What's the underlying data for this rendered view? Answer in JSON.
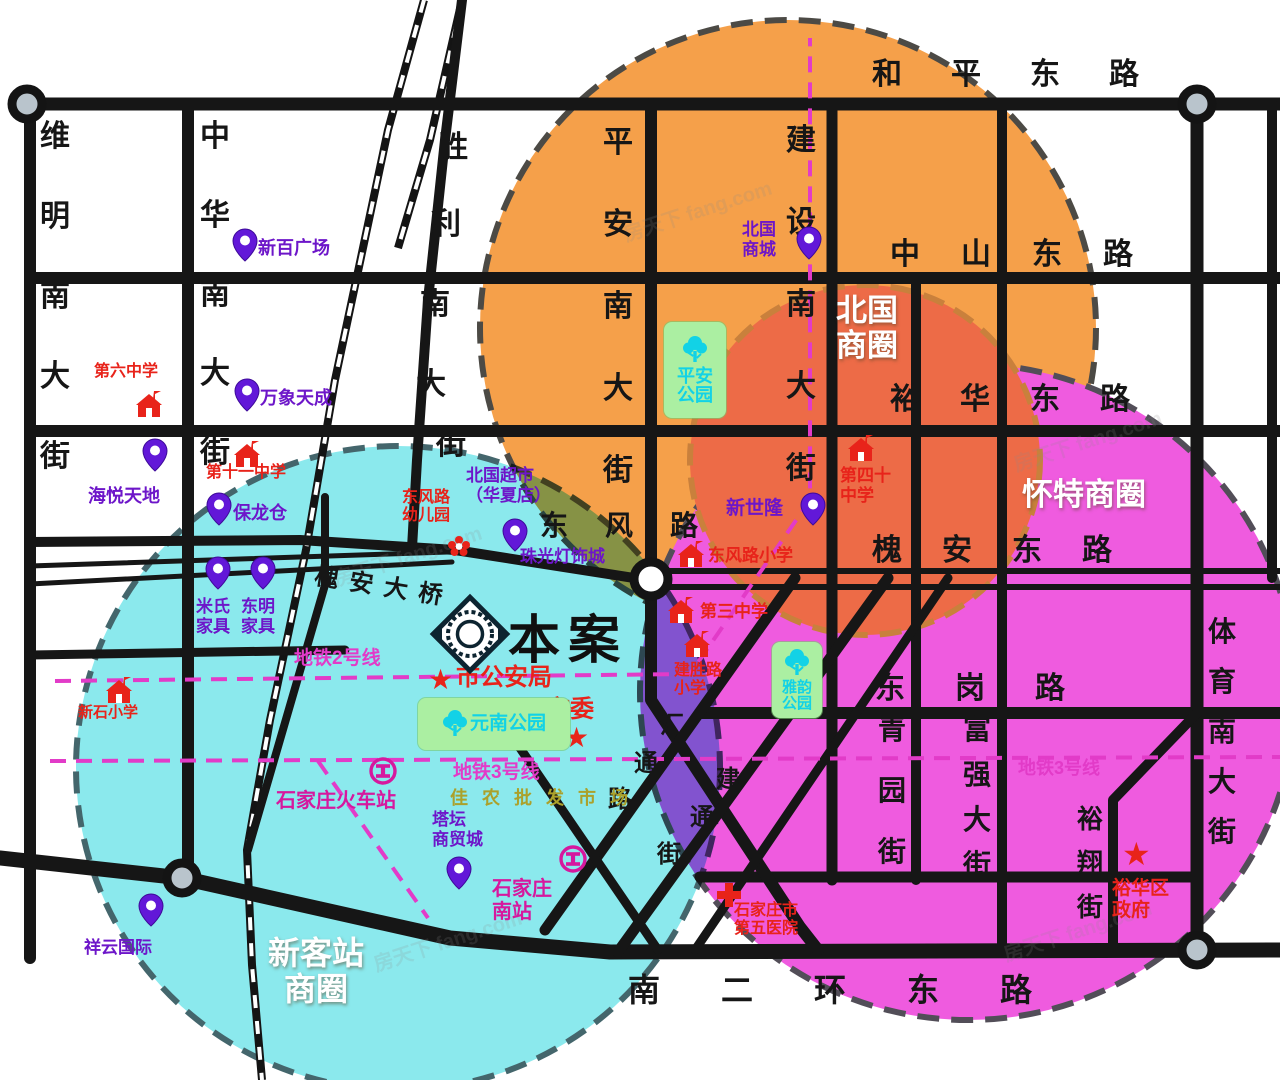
{
  "map": {
    "project_marker": {
      "label": "本案",
      "x": 424,
      "y": 588,
      "text_x": 508,
      "text_y": 598,
      "text_size": 52
    },
    "business_circles": [
      {
        "name": "北国商圈",
        "cx": 788,
        "cy": 328,
        "r": 308,
        "fill": "#F5A04A",
        "dash": "#4C4A45",
        "label_lines": [
          "北国",
          "商圈"
        ],
        "label_x": 836,
        "label_y": 294,
        "label_size": 31,
        "label_layout": "lines"
      },
      {
        "name": "怀特商圈",
        "cx": 968,
        "cy": 692,
        "r": 328,
        "fill": "#EF5BDF",
        "dash": "#524E58",
        "label_lines": [
          "怀特商圈"
        ],
        "label_x": 1022,
        "label_y": 478,
        "label_size": 31,
        "label_layout": "lines"
      },
      {
        "name": "新客站商圈",
        "cx": 398,
        "cy": 768,
        "r": 322,
        "fill": "#8BE9ED",
        "dash": "#44666C",
        "blend": "multiply",
        "label_lines": [
          "新客站",
          "商圈"
        ],
        "label_x": 268,
        "label_y": 936,
        "label_size": 32,
        "label_layout": "center"
      },
      {
        "name": "北国商圈核心",
        "cx": 865,
        "cy": 460,
        "r": 175,
        "fill": "#ED6B47",
        "dash": "#C9803C",
        "label_lines": [],
        "label_x": 0,
        "label_y": 0,
        "label_size": 0,
        "label_layout": "none"
      }
    ],
    "streets": [
      {
        "name": "和平东路",
        "o": "h",
        "x": 872,
        "y": 60,
        "sp": 79,
        "size": 30
      },
      {
        "name": "中山东路",
        "o": "h",
        "x": 890,
        "y": 240,
        "sp": 71,
        "size": 30
      },
      {
        "name": "裕华东路",
        "o": "h",
        "x": 890,
        "y": 385,
        "sp": 70,
        "size": 30
      },
      {
        "name": "槐安东路",
        "o": "h",
        "x": 872,
        "y": 536,
        "sp": 70,
        "size": 30
      },
      {
        "name": "东风路",
        "o": "h",
        "x": 540,
        "y": 512,
        "sp": 65,
        "size": 28
      },
      {
        "name": "东岗路",
        "o": "h",
        "x": 875,
        "y": 674,
        "sp": 80,
        "size": 30
      },
      {
        "name": "南二环东路",
        "o": "h",
        "x": 628,
        "y": 974,
        "sp": 93,
        "size": 32
      },
      {
        "name": "维明南大街",
        "o": "v",
        "x": 40,
        "y": 122,
        "sp": 80,
        "size": 30
      },
      {
        "name": "中华南大街",
        "o": "v",
        "x": 200,
        "y": 122,
        "sp": 79,
        "size": 30
      },
      {
        "name": "胜利南大街",
        "o": "v",
        "size": 30,
        "pos": [
          [
            438,
            133
          ],
          [
            431,
            210
          ],
          [
            420,
            290
          ],
          [
            416,
            370
          ],
          [
            436,
            430
          ]
        ]
      },
      {
        "name": "平安南大街",
        "o": "v",
        "x": 603,
        "y": 128,
        "sp": 82,
        "size": 30
      },
      {
        "name": "建设南大街",
        "o": "v",
        "x": 786,
        "y": 126,
        "sp": 82,
        "size": 30
      },
      {
        "name": "青园街",
        "o": "v",
        "x": 878,
        "y": 716,
        "sp": 61,
        "size": 28
      },
      {
        "name": "富强大街",
        "o": "v",
        "x": 963,
        "y": 716,
        "sp": 45,
        "size": 28
      },
      {
        "name": "裕翔街",
        "o": "v",
        "x": 1077,
        "y": 806,
        "sp": 44,
        "size": 26
      },
      {
        "name": "体育南大街",
        "o": "v",
        "x": 1208,
        "y": 618,
        "sp": 50,
        "size": 28
      },
      {
        "name": "槐安大桥",
        "o": "h",
        "x": 318,
        "y": 556,
        "sp": 35,
        "size": 24,
        "rotate": 9
      },
      {
        "name": "汇通路",
        "o": "v",
        "size": 24,
        "pos": [
          [
            660,
            714
          ],
          [
            634,
            752
          ],
          [
            608,
            788
          ]
        ]
      },
      {
        "name": "建通街",
        "o": "v",
        "size": 24,
        "pos": [
          [
            716,
            768
          ],
          [
            690,
            806
          ],
          [
            657,
            843
          ]
        ]
      }
    ],
    "pois": [
      {
        "type": "pin",
        "x": 232,
        "y": 228,
        "label": "新百广场",
        "lx": 258,
        "ly": 238,
        "lc": "purple",
        "ls": 18
      },
      {
        "type": "pin",
        "x": 234,
        "y": 378,
        "label": "万象天成",
        "lx": 260,
        "ly": 388,
        "lc": "purple",
        "ls": 18
      },
      {
        "type": "school",
        "x": 134,
        "y": 390,
        "label": "第六中学",
        "lx": 94,
        "ly": 363,
        "lc": "red",
        "ls": 16
      },
      {
        "type": "pin",
        "x": 142,
        "y": 438,
        "label": "海悦天地",
        "lx": 88,
        "ly": 486,
        "lc": "purple",
        "ls": 18
      },
      {
        "type": "school",
        "x": 232,
        "y": 440,
        "label": "第十一中学",
        "lx": 206,
        "ly": 464,
        "lc": "red",
        "ls": 16
      },
      {
        "type": "pin",
        "x": 206,
        "y": 492,
        "label": "保龙仓",
        "lx": 233,
        "ly": 503,
        "lc": "purple",
        "ls": 18
      },
      {
        "type": "pin",
        "x": 205,
        "y": 556,
        "label": "米氏\n家具",
        "lx": 196,
        "ly": 597,
        "lc": "purple",
        "ls": 17
      },
      {
        "type": "pin",
        "x": 250,
        "y": 556,
        "label": "东明\n家具",
        "lx": 241,
        "ly": 597,
        "lc": "purple",
        "ls": 17
      },
      {
        "type": "school",
        "x": 104,
        "y": 676,
        "label": "新石小学",
        "lx": 78,
        "ly": 704,
        "lc": "red",
        "ls": 15
      },
      {
        "type": "pin",
        "x": 138,
        "y": 893,
        "label": "祥云国际",
        "lx": 84,
        "ly": 938,
        "lc": "purple",
        "ls": 17
      },
      {
        "type": "flower",
        "x": 446,
        "y": 534,
        "label": "东风路\n幼儿园",
        "lx": 402,
        "ly": 489,
        "lc": "red",
        "ls": 16
      },
      {
        "type": "text",
        "x": 0,
        "y": 0,
        "label": "北国超市\n（华夏店）",
        "lx": 466,
        "ly": 466,
        "lc": "purple",
        "ls": 17
      },
      {
        "type": "pin",
        "x": 502,
        "y": 518,
        "label": "珠光灯饰城",
        "lx": 520,
        "ly": 547,
        "lc": "purple",
        "ls": 17
      },
      {
        "type": "school",
        "x": 676,
        "y": 540,
        "label": "东风路小学",
        "lx": 708,
        "ly": 546,
        "lc": "red",
        "ls": 17
      },
      {
        "type": "pin",
        "x": 800,
        "y": 492,
        "label": "新世隆",
        "lx": 726,
        "ly": 498,
        "lc": "purple",
        "ls": 19
      },
      {
        "type": "pin",
        "x": 796,
        "y": 226,
        "label": "北国\n商城",
        "lx": 742,
        "ly": 220,
        "lc": "purple",
        "ls": 17
      },
      {
        "type": "school",
        "x": 846,
        "y": 434,
        "label": "第四十\n中学",
        "lx": 840,
        "ly": 466,
        "lc": "red",
        "ls": 17
      },
      {
        "type": "school",
        "x": 666,
        "y": 596,
        "label": "第三中学",
        "lx": 700,
        "ly": 602,
        "lc": "red",
        "ls": 17
      },
      {
        "type": "school",
        "x": 682,
        "y": 630,
        "label": "建胜路\n小学",
        "lx": 674,
        "ly": 662,
        "lc": "red",
        "ls": 16
      },
      {
        "type": "star",
        "x": 428,
        "y": 666,
        "label": "市公安局",
        "lx": 456,
        "ly": 664,
        "lc": "red",
        "ls": 24,
        "star": 28
      },
      {
        "type": "star",
        "x": 564,
        "y": 724,
        "label": "市委",
        "lx": 546,
        "ly": 696,
        "lc": "red",
        "ls": 24,
        "star": 28
      },
      {
        "type": "rail",
        "x": 368,
        "y": 756,
        "label": "石家庄火车站",
        "lx": 276,
        "ly": 790,
        "lc": "magenta",
        "ls": 20
      },
      {
        "type": "text",
        "x": 0,
        "y": 0,
        "label": "佳农批发市场",
        "lx": 450,
        "ly": 788,
        "lc": "olive",
        "ls": 18,
        "spread": 14
      },
      {
        "type": "pin",
        "x": 446,
        "y": 856,
        "label": "塔坛\n商贸城",
        "lx": 432,
        "ly": 810,
        "lc": "purple",
        "ls": 17
      },
      {
        "type": "rail",
        "x": 558,
        "y": 844,
        "label": "石家庄\n南站",
        "lx": 492,
        "ly": 878,
        "lc": "magenta",
        "ls": 20
      },
      {
        "type": "hospital",
        "x": 716,
        "y": 882,
        "label": "石家庄市\n第五医院",
        "lx": 734,
        "ly": 902,
        "lc": "red",
        "ls": 16
      },
      {
        "type": "star",
        "x": 1122,
        "y": 838,
        "label": "裕华区\n政府",
        "lx": 1112,
        "ly": 878,
        "lc": "red",
        "ls": 19,
        "star": 32
      },
      {
        "type": "text",
        "x": 0,
        "y": 0,
        "label": "地铁2号线",
        "lx": 294,
        "ly": 648,
        "lc": "metro",
        "ls": 19
      },
      {
        "type": "text",
        "x": 0,
        "y": 0,
        "label": "地铁3号线",
        "lx": 453,
        "ly": 762,
        "lc": "metro",
        "ls": 19
      },
      {
        "type": "text",
        "x": 0,
        "y": 0,
        "label": "地铁3号线",
        "lx": 1018,
        "ly": 758,
        "lc": "metro",
        "ls": 18
      }
    ],
    "parks": [
      {
        "name": "平安公园",
        "lines": [
          "平安",
          "公园"
        ],
        "x": 664,
        "y": 322,
        "w": 62,
        "h": 96,
        "layout": "v",
        "ts": 18
      },
      {
        "name": "雅韵公园",
        "lines": [
          "雅韵",
          "公园"
        ],
        "x": 772,
        "y": 642,
        "w": 50,
        "h": 76,
        "layout": "v",
        "ts": 15
      },
      {
        "name": "元南公园",
        "lines": [
          "元南公园"
        ],
        "x": 418,
        "y": 698,
        "w": 152,
        "h": 52,
        "layout": "h",
        "ts": 19
      }
    ],
    "metro_lines": [
      {
        "name": "地铁2号线",
        "d": "M55,681 L690,674 L810,500 L810,38"
      },
      {
        "name": "地铁3号线",
        "d": "M50,761 L1280,757"
      },
      {
        "name": "地铁3号线支线",
        "d": "M318,761 L428,918"
      }
    ],
    "roads": [
      {
        "d": "M30,104 H1280",
        "w": 13
      },
      {
        "d": "M30,278 H1280",
        "w": 12
      },
      {
        "d": "M30,431 H1280",
        "w": 12
      },
      {
        "d": "M700,713 H1280",
        "w": 12
      },
      {
        "d": "M700,877 H1197",
        "w": 11
      },
      {
        "d": "M0,858 L182,878 L450,938 L610,952 L1280,950",
        "w": 15
      },
      {
        "d": "M30,104 V958",
        "w": 12
      },
      {
        "d": "M188,104 V878",
        "w": 12
      },
      {
        "d": "M462,0 L445,140 L428,300 L417,460 L412,548",
        "w": 10
      },
      {
        "d": "M651,104 V562",
        "w": 12
      },
      {
        "d": "M651,596 V700 L800,927 L818,950",
        "w": 12
      },
      {
        "d": "M832,104 V880",
        "w": 11
      },
      {
        "d": "M916,278 V880",
        "w": 10
      },
      {
        "d": "M1002,104 V945",
        "w": 10
      },
      {
        "d": "M1197,104 V950",
        "w": 13
      },
      {
        "d": "M1272,104 V578",
        "w": 10
      },
      {
        "d": "M1197,713 L1113,800 V945",
        "w": 10
      },
      {
        "d": "M30,542 L300,540 L455,550 L640,579",
        "w": 10
      },
      {
        "d": "M30,566 L448,552",
        "w": 5
      },
      {
        "d": "M30,584 L452,562",
        "w": 5
      },
      {
        "d": "M668,571 H1280",
        "w": 6
      },
      {
        "d": "M668,587 H1280",
        "w": 6
      },
      {
        "d": "M795,578 L545,930",
        "w": 11
      },
      {
        "d": "M888,578 L618,952",
        "w": 11
      },
      {
        "d": "M948,578 L695,950",
        "w": 9
      },
      {
        "d": "M520,748 L658,950",
        "w": 9
      },
      {
        "d": "M30,655 L345,650",
        "w": 9
      },
      {
        "d": "M325,497 V585 L248,850",
        "w": 8
      },
      {
        "d": "M412,548 L455,550",
        "w": 8
      }
    ],
    "railway": [
      {
        "d": "M424,0 L388,130 L335,380 L306,550 L270,720 L247,850 L252,965 L262,1080"
      },
      {
        "d": "M462,0 L430,140 L398,248"
      }
    ],
    "interchanges": [
      {
        "x": 27,
        "y": 104,
        "fill": "#b9c4cc",
        "r": 15
      },
      {
        "x": 1197,
        "y": 104,
        "fill": "#b9c4cc",
        "r": 15
      },
      {
        "x": 182,
        "y": 878,
        "fill": "#b9c4cc",
        "r": 15
      },
      {
        "x": 1197,
        "y": 950,
        "fill": "#b9c4cc",
        "r": 15
      },
      {
        "x": 651,
        "y": 579,
        "fill": "#ffffff",
        "r": 17
      }
    ],
    "colors": {
      "road": "#161616",
      "metro": "#E23BC8",
      "purple": "#6d16c9",
      "red": "#e8231a",
      "magenta": "#d6189e",
      "olive": "#aba12b",
      "cyan": "#12d2e6",
      "orange_circle": "#F5A04A",
      "core_circle": "#ED6B47",
      "pink_circle": "#EF5BDF",
      "cyan_circle": "#8BE9ED"
    },
    "watermarks": [
      {
        "text": "房天下 fang.com",
        "x": 620,
        "y": 195
      },
      {
        "text": "房天下 fang.com",
        "x": 1010,
        "y": 425
      },
      {
        "text": "房天下 fang.com",
        "x": 330,
        "y": 540
      },
      {
        "text": "房天下 fang.com",
        "x": 370,
        "y": 925
      },
      {
        "text": "房天下 fang.com",
        "x": 1000,
        "y": 915
      }
    ]
  }
}
